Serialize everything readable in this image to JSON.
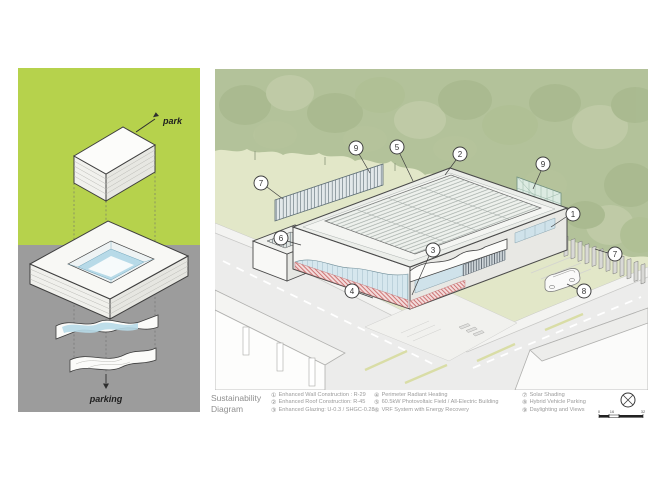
{
  "left_panel": {
    "park_label": "park",
    "parking_label": "parking",
    "colors": {
      "park_bg": "#b6d24c",
      "parking_bg": "#9c9c9c",
      "glass_blue": "#b7dae8"
    }
  },
  "right_panel": {
    "colors": {
      "tree_green": "#b3c29a",
      "lawn_green": "#e2e7c8",
      "street_gray": "#ececeb",
      "heating_pink": "#c96a6a",
      "screen_teal": "#dcebe2"
    },
    "callouts": [
      {
        "n": "1"
      },
      {
        "n": "2"
      },
      {
        "n": "3"
      },
      {
        "n": "4"
      },
      {
        "n": "5"
      },
      {
        "n": "6"
      },
      {
        "n": "7"
      },
      {
        "n": "7"
      },
      {
        "n": "8"
      },
      {
        "n": "9"
      },
      {
        "n": "9"
      }
    ]
  },
  "legend": {
    "title": "Sustainability Diagram",
    "columns": [
      {
        "items": [
          {
            "num": "①",
            "text": "Enhanced Wall Construction : R-29"
          },
          {
            "num": "②",
            "text": "Enhanced Roof Construction: R-45"
          },
          {
            "num": "③",
            "text": "Enhanced Glazing: U-0.3 / SHGC-0.28"
          }
        ]
      },
      {
        "items": [
          {
            "num": "④",
            "text": "Perimeter Radiant Heating"
          },
          {
            "num": "⑤",
            "text": "60.5kW Photovoltaic Field / All-Electric Building"
          },
          {
            "num": "⑥",
            "text": "VRF System with Energy Recovery"
          }
        ]
      },
      {
        "items": [
          {
            "num": "⑦",
            "text": "Solar Shading"
          },
          {
            "num": "⑧",
            "text": "Hybrid Vehicle Parking"
          },
          {
            "num": "⑨",
            "text": "Daylighting and Views"
          }
        ]
      }
    ],
    "scale": {
      "labels": [
        "0",
        "16",
        "32"
      ]
    }
  }
}
